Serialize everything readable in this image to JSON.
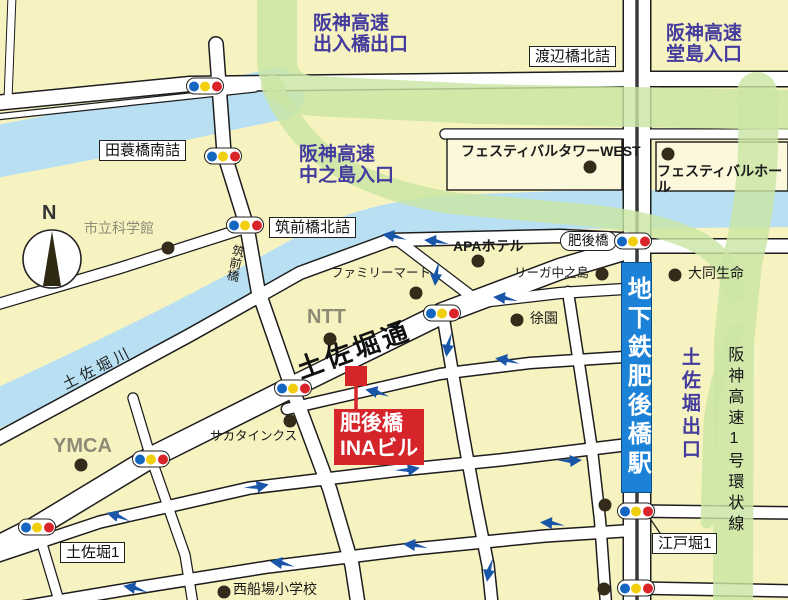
{
  "colors": {
    "purple": "#433b9e",
    "red": "#d6252a",
    "subway": "#1b82d8",
    "river": "#b9e0f2",
    "green": "#c9e5a3",
    "road": "#ffffff",
    "bg": "#f7f3c0",
    "arrow": "#1a56a8"
  },
  "labels": [
    {
      "id": "hanshin-deiribashi-exit",
      "text": "阪神高速\n出入橋出口",
      "x": 313,
      "y": 13,
      "cls": "hwy"
    },
    {
      "id": "watanabebashi-kitazume",
      "text": "渡辺橋北詰",
      "x": 529,
      "y": 46,
      "cls": "box"
    },
    {
      "id": "hanshin-dojima-entrance",
      "text": "阪神高速\n堂島入口",
      "x": 666,
      "y": 23,
      "cls": "hwy"
    },
    {
      "id": "tamigusabashi-minamizume",
      "text": "田蓑橋南詰",
      "x": 99,
      "y": 140,
      "cls": "box"
    },
    {
      "id": "shiritsu-kagakukan",
      "text": "市立科学館",
      "x": 84,
      "y": 220,
      "cls": "gray md"
    },
    {
      "id": "hanshin-nakanoshima-entrance",
      "text": "阪神高速\n中之島入口",
      "x": 299,
      "y": 144,
      "cls": "hwy"
    },
    {
      "id": "chikuzenbashi-kitazume",
      "text": "筑前橋北詰",
      "x": 269,
      "y": 217,
      "cls": "box"
    },
    {
      "id": "chikuzenbashi-bridge",
      "text": "筑前橋",
      "x": 231,
      "y": 243,
      "cls": "vert sm",
      "rot": 12
    },
    {
      "id": "festival-tower-west",
      "text": "フェスティバルタワーWEST",
      "x": 461,
      "y": 143,
      "cls": "bold md"
    },
    {
      "id": "festival-hall",
      "text": "フェスティバルホール",
      "x": 657,
      "y": 163,
      "cls": "bold md"
    },
    {
      "id": "higobashi-bridge",
      "text": "肥後橋",
      "x": 560,
      "y": 231,
      "cls": "box round"
    },
    {
      "id": "apa-hotel",
      "text": "APAホテル",
      "x": 453,
      "y": 238,
      "cls": "bold md"
    },
    {
      "id": "riga-nakanoshima",
      "text": "リーガ中之島",
      "x": 514,
      "y": 266,
      "cls": "sm"
    },
    {
      "id": "family-mart",
      "text": "ファミリーマート",
      "x": 331,
      "y": 266,
      "cls": "sm"
    },
    {
      "id": "ntt",
      "text": "NTT",
      "x": 307,
      "y": 306,
      "cls": "gray big"
    },
    {
      "id": "joen",
      "text": "徐園",
      "x": 530,
      "y": 310,
      "cls": "md"
    },
    {
      "id": "tosabori-dori-street",
      "text": "土佐堀通",
      "x": 293,
      "y": 357,
      "cls": "street",
      "rot": -20
    },
    {
      "id": "higobashi-ina-building-label",
      "text": "肥後橋\nINAビル",
      "x": 334,
      "y": 409,
      "cls": "redbox"
    },
    {
      "id": "daido-seimei",
      "text": "大同生命",
      "x": 688,
      "y": 265,
      "cls": "md"
    },
    {
      "id": "ymca",
      "text": "YMCA",
      "x": 53,
      "y": 435,
      "cls": "gray big"
    },
    {
      "id": "sakata-inx",
      "text": "サカタインクス",
      "x": 210,
      "y": 429,
      "cls": "sm"
    },
    {
      "id": "tosabori-1",
      "text": "土佐堀1",
      "x": 60,
      "y": 542,
      "cls": "box"
    },
    {
      "id": "nishifunaba-elementary",
      "text": "西船場小学校",
      "x": 233,
      "y": 581,
      "cls": "md"
    },
    {
      "id": "subway-higobashi-station",
      "text": "地下鉄肥後橋駅",
      "x": 621,
      "y": 262,
      "cls": "subway"
    },
    {
      "id": "tosabori-exit",
      "text": "土佐堀出口",
      "x": 678,
      "y": 347,
      "cls": "vert hwy-v"
    },
    {
      "id": "hanshin-loop-line",
      "text": "阪神高速1号環状線",
      "x": 724,
      "y": 346,
      "cls": "vert loop"
    },
    {
      "id": "edobori-1",
      "text": "江戸堀1",
      "x": 652,
      "y": 533,
      "cls": "box"
    },
    {
      "id": "tosabori-river",
      "text": "土佐堀川",
      "x": 60,
      "y": 378,
      "cls": "river-label",
      "rot": -27
    },
    {
      "id": "compass-north-label",
      "text": "N",
      "x": 42,
      "y": 202,
      "cls": "compass-n"
    }
  ],
  "traffic_lights": [
    {
      "x": 205,
      "y": 86
    },
    {
      "x": 223,
      "y": 156
    },
    {
      "x": 245,
      "y": 225
    },
    {
      "x": 633,
      "y": 241
    },
    {
      "x": 442,
      "y": 313
    },
    {
      "x": 293,
      "y": 388
    },
    {
      "x": 151,
      "y": 459
    },
    {
      "x": 37,
      "y": 527
    },
    {
      "x": 636,
      "y": 511
    },
    {
      "x": 636,
      "y": 588
    }
  ],
  "poi_dots": [
    {
      "x": 168,
      "y": 248
    },
    {
      "x": 590,
      "y": 167
    },
    {
      "x": 668,
      "y": 154
    },
    {
      "x": 478,
      "y": 261
    },
    {
      "x": 416,
      "y": 293
    },
    {
      "x": 602,
      "y": 274
    },
    {
      "x": 330,
      "y": 339
    },
    {
      "x": 517,
      "y": 320
    },
    {
      "x": 675,
      "y": 275
    },
    {
      "x": 81,
      "y": 465
    },
    {
      "x": 290,
      "y": 421
    },
    {
      "x": 224,
      "y": 592
    },
    {
      "x": 605,
      "y": 505
    },
    {
      "x": 604,
      "y": 589
    }
  ],
  "one_way_arrows": [
    {
      "x": 505,
      "y": 298,
      "angle": 185
    },
    {
      "x": 394,
      "y": 236,
      "angle": 188
    },
    {
      "x": 436,
      "y": 241,
      "angle": 185
    },
    {
      "x": 436,
      "y": 274,
      "angle": 95
    },
    {
      "x": 448,
      "y": 345,
      "angle": 98
    },
    {
      "x": 377,
      "y": 392,
      "angle": 192
    },
    {
      "x": 507,
      "y": 360,
      "angle": 188
    },
    {
      "x": 257,
      "y": 487,
      "angle": 348
    },
    {
      "x": 118,
      "y": 516,
      "angle": 195
    },
    {
      "x": 408,
      "y": 470,
      "angle": 350
    },
    {
      "x": 570,
      "y": 461,
      "angle": 355
    },
    {
      "x": 135,
      "y": 588,
      "angle": 190
    },
    {
      "x": 282,
      "y": 563,
      "angle": 188
    },
    {
      "x": 415,
      "y": 545,
      "angle": 185
    },
    {
      "x": 552,
      "y": 523,
      "angle": 183
    },
    {
      "x": 489,
      "y": 570,
      "angle": 100
    }
  ]
}
